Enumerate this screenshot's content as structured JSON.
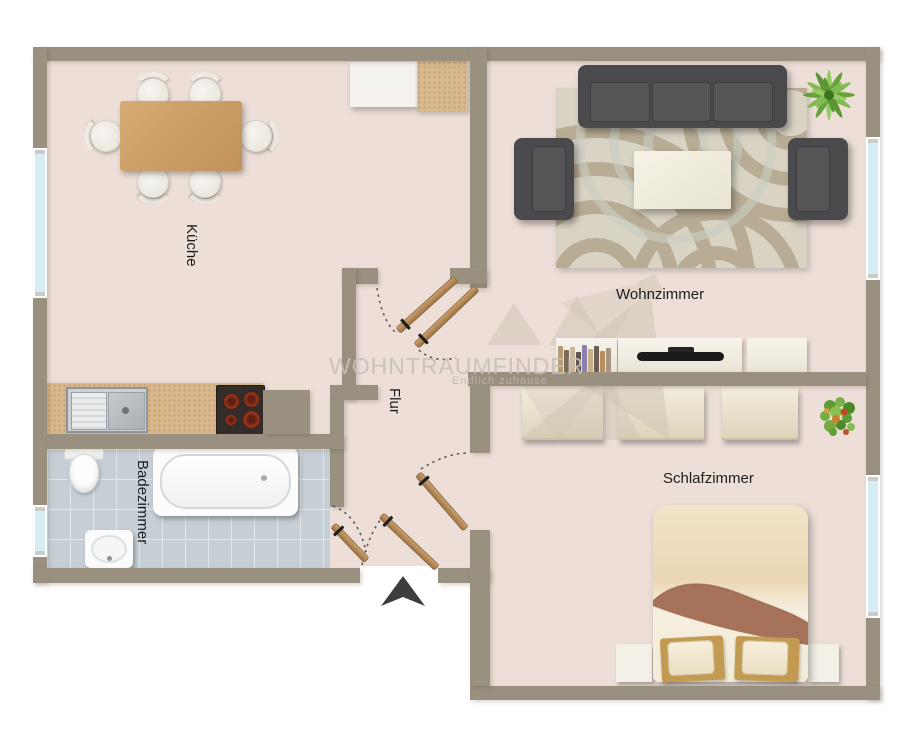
{
  "palette": {
    "wall": "#9a9080",
    "floor": "#eddfd8",
    "tile": "#c6cfd5",
    "grout": "#dfe5e9",
    "window": "#d6edf3",
    "label": "#1d1d1d",
    "watermark": "#c6c0b7",
    "arrow": "#3d3d3d",
    "wood": "#bc8f5c",
    "sofa": "#4a4a4c"
  },
  "rooms": {
    "kueche": {
      "label": "Küche"
    },
    "wohnzimmer": {
      "label": "Wohnzimmer"
    },
    "flur": {
      "label": "Flur"
    },
    "badezimmer": {
      "label": "Badezimmer"
    },
    "schlafzimmer": {
      "label": "Schlafzimmer"
    }
  },
  "watermark": {
    "title": "WOHNTRAUMFINDER",
    "tagline": "Endlich zuhause"
  },
  "icons": {
    "entrance_arrow": "triangle-up",
    "palm_plant": "palm",
    "potted_plant": "shrub"
  }
}
